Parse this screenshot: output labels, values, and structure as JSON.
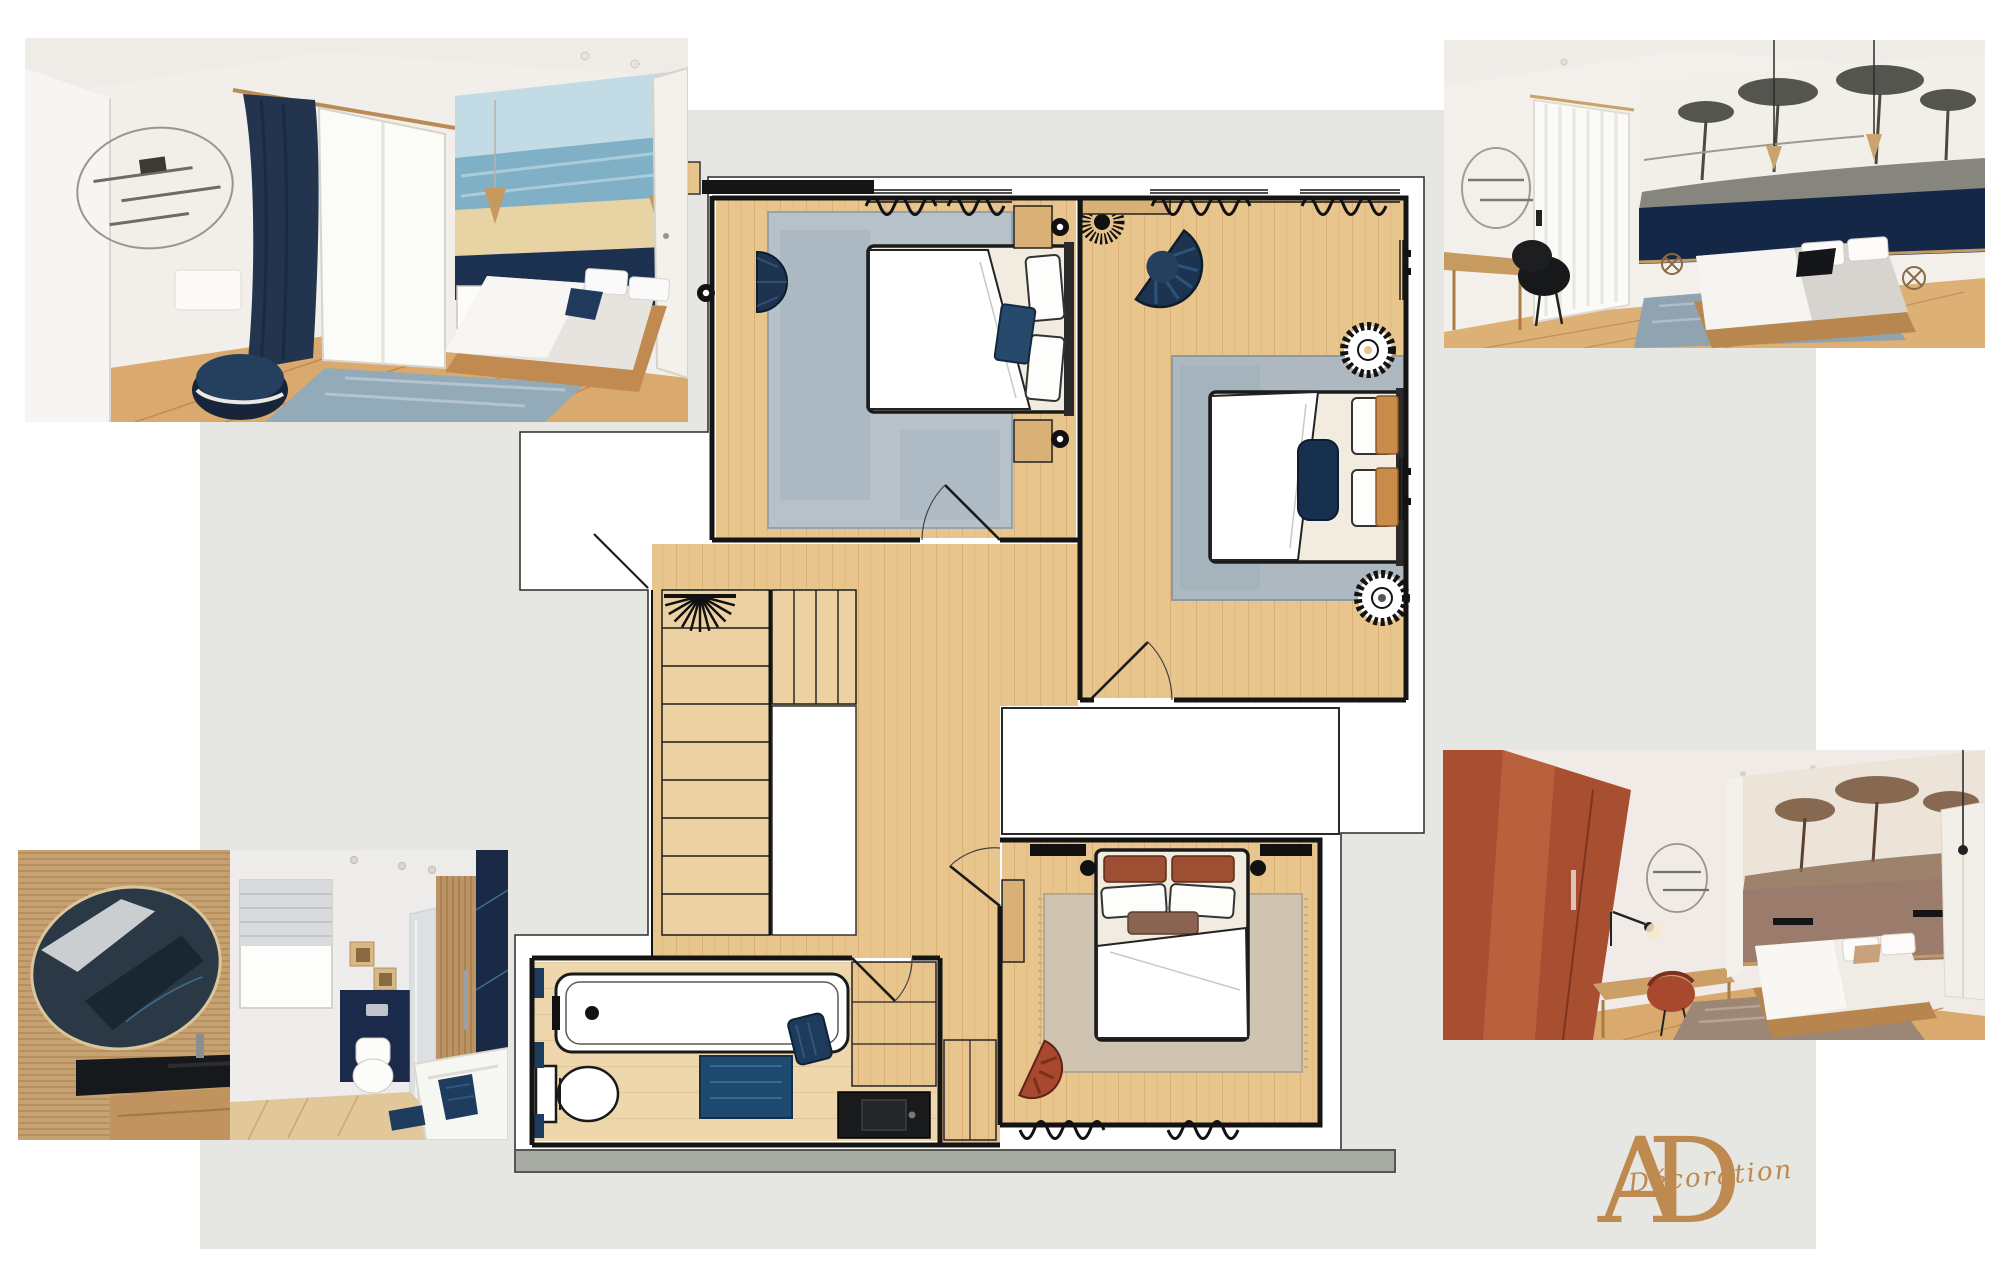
{
  "page": {
    "width": 2004,
    "height": 1276,
    "background": "#ffffff"
  },
  "backdrop": {
    "color": "#e6e7e3"
  },
  "logo": {
    "letter_a": "A",
    "letter_d": "D",
    "script": "Décoration",
    "color": "#bf8a50"
  },
  "palette": {
    "wood_floor": "#e9c58e",
    "wood_light": "#eed7ad",
    "stair_wood": "#ecd2a2",
    "wall_line": "#141414",
    "navy": "#1e3a5c",
    "navy_dark": "#152747",
    "rug_blue": "#b6c1c9",
    "rug_taupe": "#cfc4b2",
    "terracotta": "#a84e31",
    "sand": "#e8d3a4",
    "sea": "#7fb0c6",
    "sky": "#c2dbe4",
    "gold": "#bf8a50",
    "section_band": "#a8aaa4"
  },
  "floor_plan": {
    "name": "first-floor-plan",
    "rooms": [
      {
        "id": "bedroom-1",
        "label": "bedroom-seaside",
        "features": [
          "double-bed",
          "blue-rug",
          "two-nightstands",
          "wall-sconces",
          "half-moon-pouf",
          "curtain-window",
          "wardrobe-band",
          "door-swing"
        ]
      },
      {
        "id": "bedroom-2",
        "label": "bedroom-savanna",
        "features": [
          "double-bed",
          "navy-bolster",
          "patterned-pillows",
          "large-blue-rug",
          "rattan-ring-lamps",
          "fan-armchair",
          "desk",
          "spiky-pendant-lamp",
          "curtain-windows",
          "door-swing"
        ]
      },
      {
        "id": "landing",
        "label": "stair-landing",
        "features": [
          "staircase",
          "winder-steps",
          "stairwell-void",
          "ceiling-fan-light",
          "railing"
        ]
      },
      {
        "id": "bathroom",
        "label": "bathroom",
        "features": [
          "bathtub",
          "toilet",
          "navy-bath-mat",
          "navy-towel",
          "black-vanity-sink",
          "rattan-pendant",
          "wall-hooks",
          "storage-cabinet"
        ]
      },
      {
        "id": "bedroom-3",
        "label": "bedroom-terracotta",
        "features": [
          "double-bed",
          "terracotta-pillows",
          "taupe-rug",
          "desk",
          "terracotta-chair",
          "wall-sconce-bars",
          "wardrobe",
          "curtain-window",
          "door-swing"
        ]
      }
    ],
    "voids": [
      "entry-notch",
      "stairwell-opening",
      "terrace-void"
    ],
    "section_band": true
  },
  "photos": [
    {
      "id": "photo-top-left",
      "label": "render-bedroom-seaside-mural"
    },
    {
      "id": "photo-top-right",
      "label": "render-bedroom-savanna-mural"
    },
    {
      "id": "photo-bottom-left",
      "label": "render-bathroom"
    },
    {
      "id": "photo-bottom-right",
      "label": "render-bedroom-terracotta"
    }
  ]
}
